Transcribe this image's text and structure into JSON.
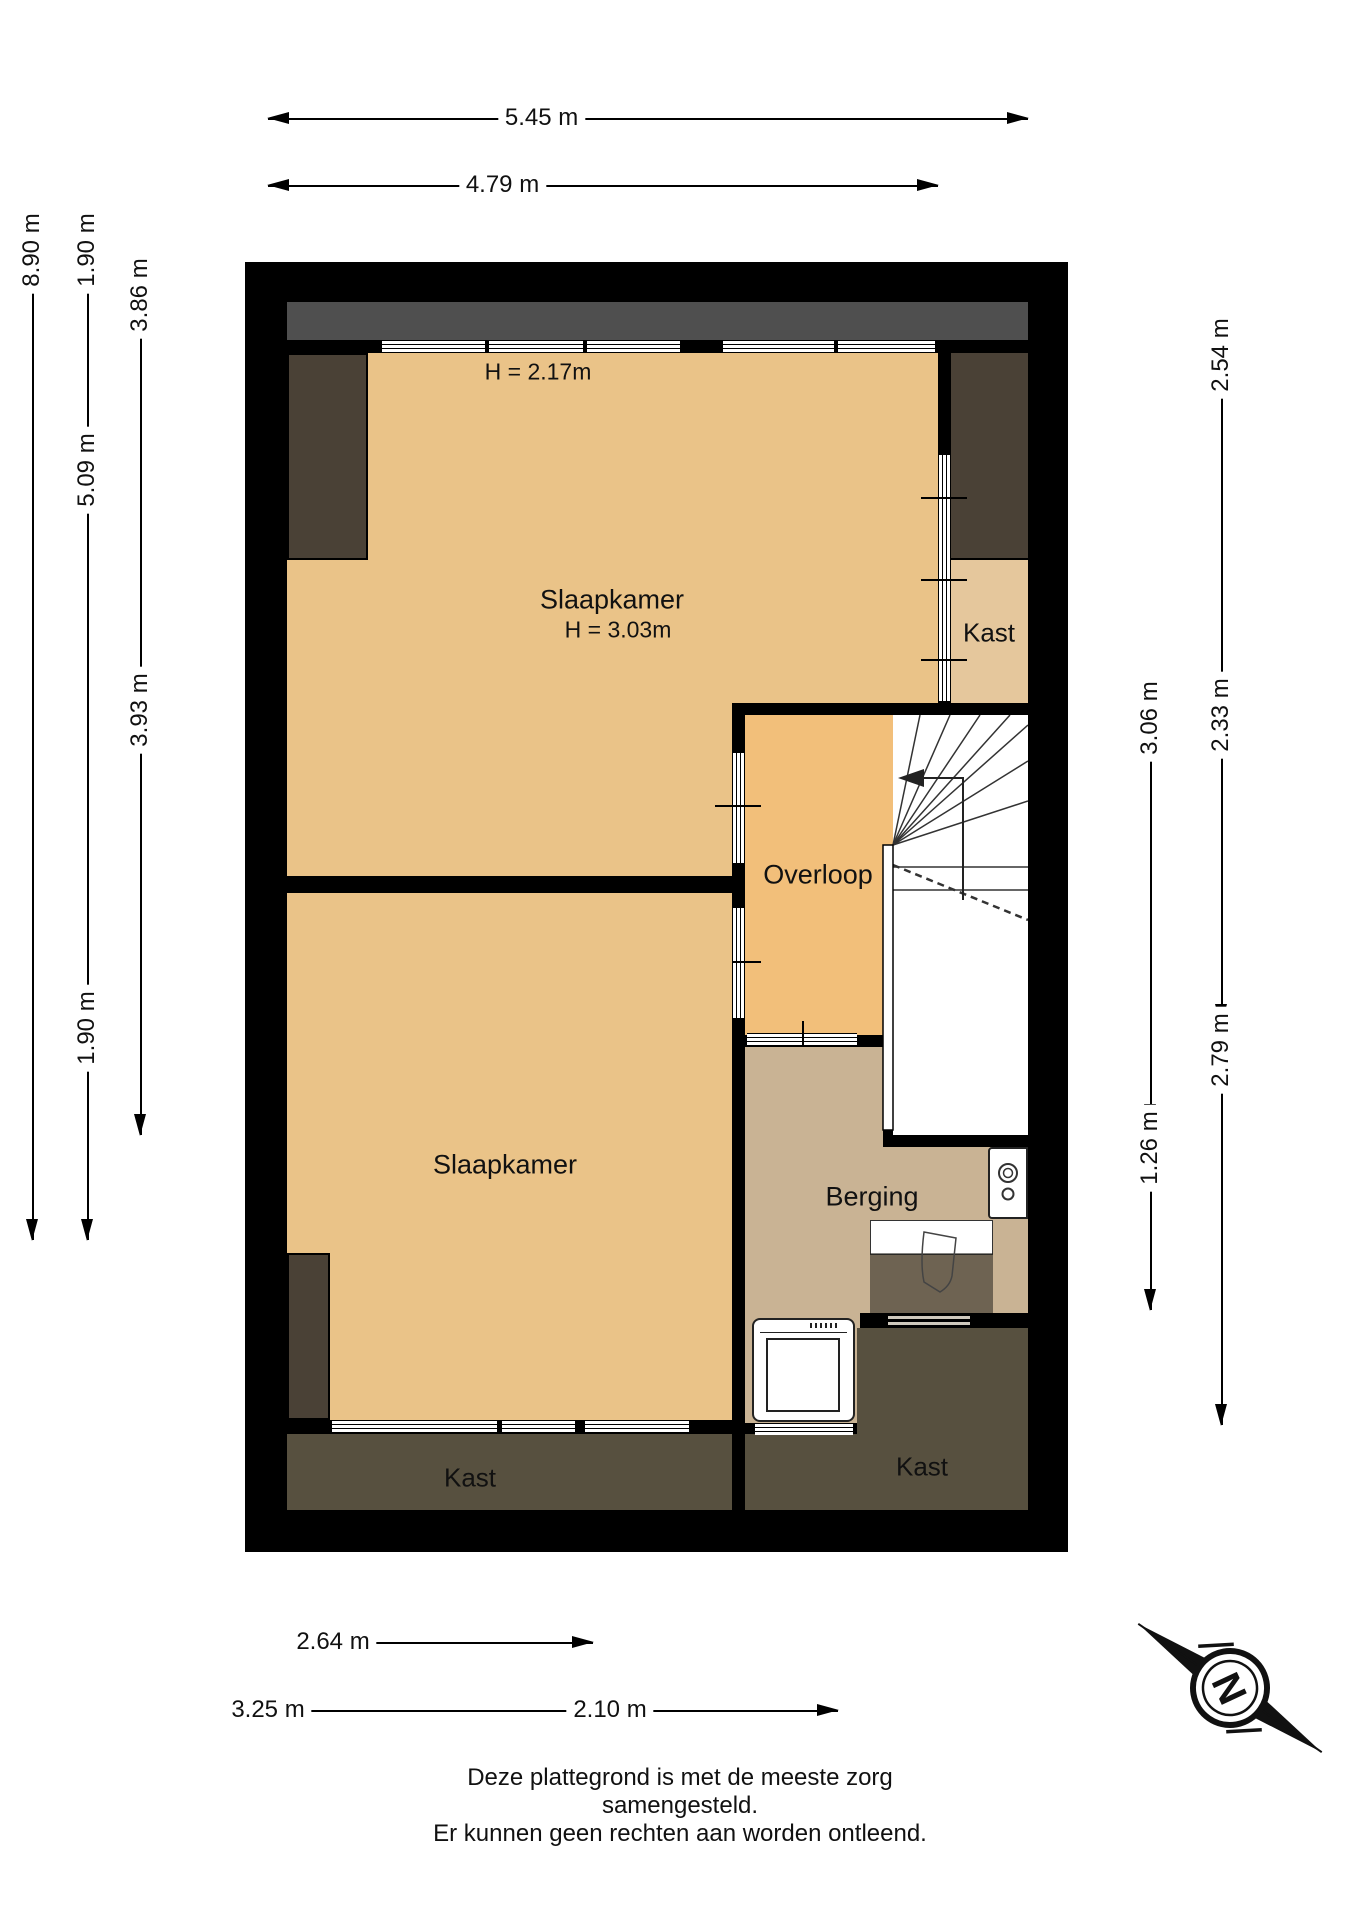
{
  "colors": {
    "wall": "#000000",
    "roof_band": "#4f4f4f",
    "bedroom_floor": "#eac388",
    "overloop_floor": "#f2bf7a",
    "kast_floor": "#e5c79c",
    "berging_floor": "#c9b394",
    "closet_dark": "#4a4136",
    "kast_band": "#57503f",
    "shower_overlay": "rgba(35,32,28,0.55)"
  },
  "rooms": {
    "slaapkamer_1": {
      "label": "Slaapkamer",
      "height_label": "H = 3.03m",
      "ceiling_label": "H = 2.17m"
    },
    "slaapkamer_2": {
      "label": "Slaapkamer"
    },
    "overloop": {
      "label": "Overloop"
    },
    "berging": {
      "label": "Berging"
    },
    "kast_top_right": {
      "label": "Kast"
    },
    "kast_bottom_left": {
      "label": "Kast"
    },
    "kast_bottom_right": {
      "label": "Kast"
    }
  },
  "dimensions": {
    "top": [
      {
        "label": "5.45 m"
      },
      {
        "label": "4.79 m"
      }
    ],
    "bottom": [
      {
        "label": "2.64 m"
      },
      {
        "label": "3.25 m"
      },
      {
        "label": "2.10 m"
      }
    ],
    "left": [
      {
        "label": "8.90 m"
      },
      {
        "label": "1.90 m"
      },
      {
        "label": "5.09 m"
      },
      {
        "label": "1.90 m"
      },
      {
        "label": "3.86 m"
      },
      {
        "label": "3.93 m"
      }
    ],
    "right": [
      {
        "label": "2.54 m"
      },
      {
        "label": "2.33 m"
      },
      {
        "label": "2.79 m"
      },
      {
        "label": "3.06 m"
      },
      {
        "label": "1.26 m"
      }
    ]
  },
  "compass": {
    "north_label": "N"
  },
  "footer": {
    "line1": "Deze plattegrond is met de meeste zorg samengesteld.",
    "line2": "Er kunnen geen rechten aan worden ontleend."
  }
}
